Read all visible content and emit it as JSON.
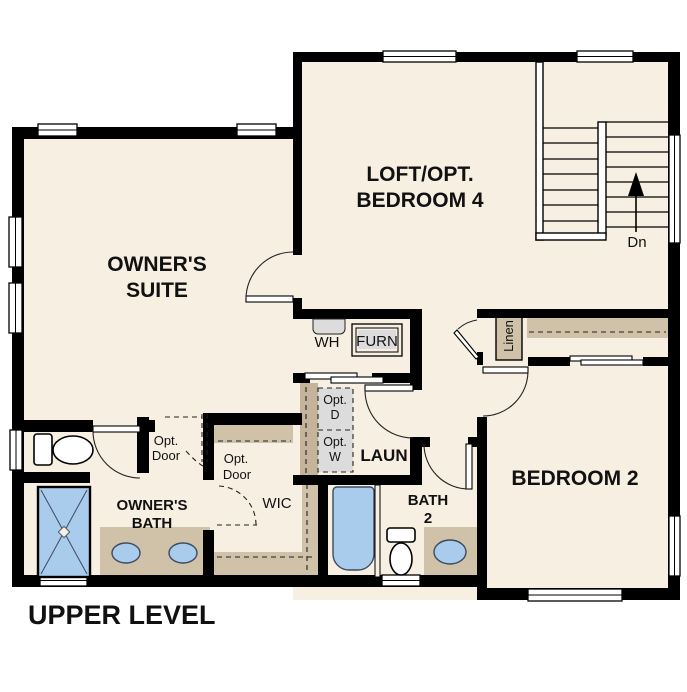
{
  "title": "UPPER LEVEL",
  "rooms": {
    "owners_suite": {
      "line1": "OWNER'S",
      "line2": "SUITE"
    },
    "loft": {
      "line1": "LOFT/OPT.",
      "line2": "BEDROOM 4"
    },
    "bedroom_2": {
      "label": "BEDROOM 2"
    },
    "owners_bath": {
      "line1": "OWNER'S",
      "line2": "BATH"
    },
    "wic": {
      "label": "WIC"
    },
    "laundry": {
      "label": "LAUN"
    },
    "bath_2": {
      "line1": "BATH",
      "line2": "2"
    },
    "linen": {
      "label": "Linen"
    }
  },
  "labels": {
    "water_heater": "WH",
    "furnace": "FURN",
    "stairs_down": "Dn",
    "opt_door_line1": "Opt.",
    "opt_door_line2": "Door",
    "opt_dryer_line1": "Opt.",
    "opt_dryer_line2": "D",
    "opt_washer_line1": "Opt.",
    "opt_washer_line2": "W"
  },
  "colors": {
    "floor": "#f7efe2",
    "wall": "#000000",
    "shelf_tan": "#cfc2a9",
    "cabinet_tan": "#c5b499",
    "fixture_blue": "#a9cbec",
    "appliance_gray": "#dcdcdc"
  }
}
